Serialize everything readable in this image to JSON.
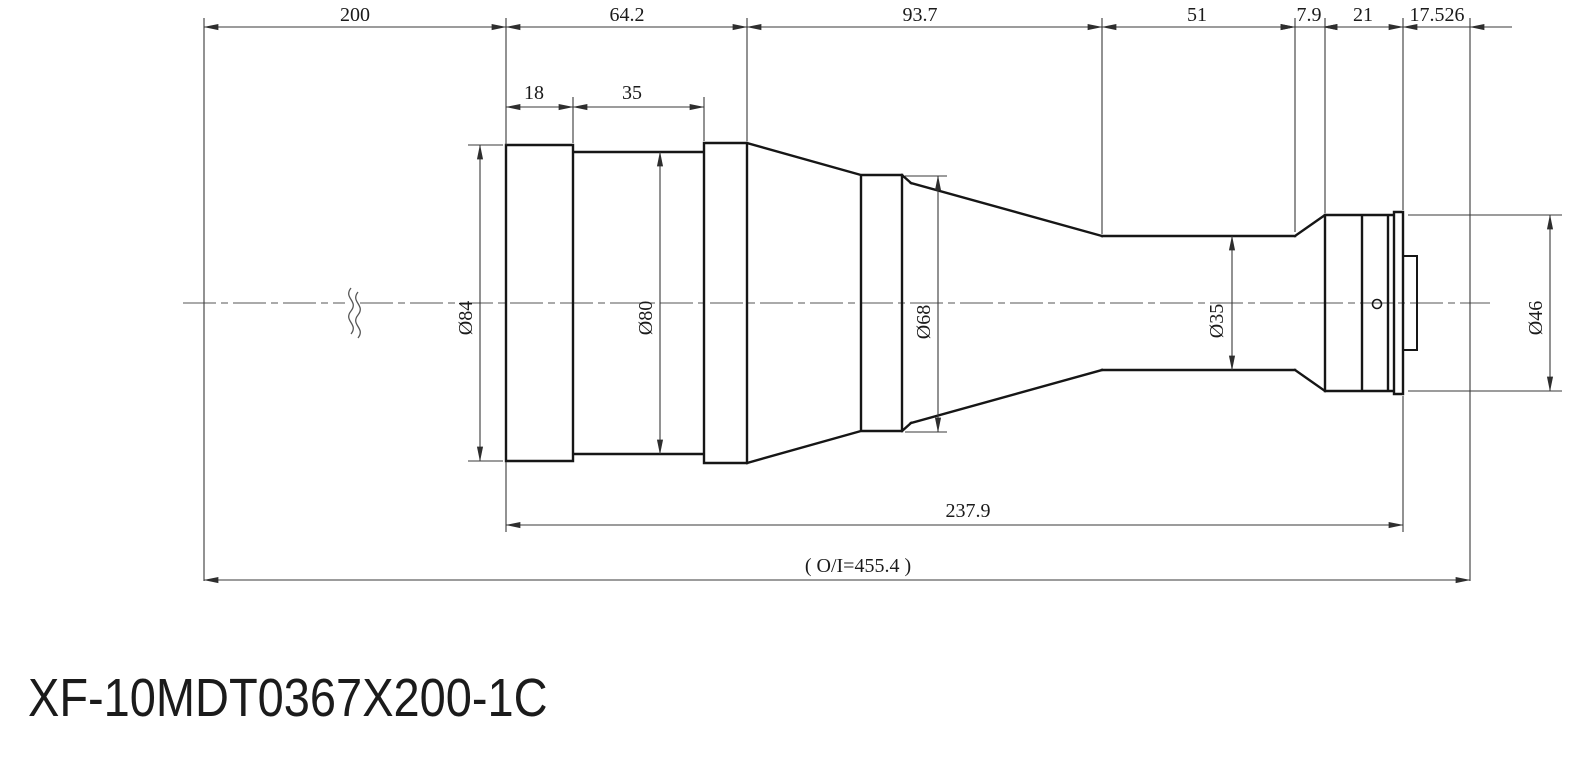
{
  "title": "XF-10MDT0367X200-1C",
  "dims": {
    "top": {
      "d200": "200",
      "d64_2": "64.2",
      "d93_7": "93.7",
      "d51": "51",
      "d7_9": "7.9",
      "d21": "21",
      "d17_526": "17.526"
    },
    "sub": {
      "d18": "18",
      "d35": "35"
    },
    "diameters": {
      "dia84": "Ø84",
      "dia80": "Ø80",
      "dia68": "Ø68",
      "dia35": "Ø35",
      "dia46": "Ø46"
    },
    "bottom": {
      "d237_9": "237.9",
      "oi": "( O/I=455.4 )"
    }
  },
  "colors": {
    "background": "#ffffff",
    "outline": "#161616",
    "dim_line": "#3a3a3a",
    "centerline": "#555555",
    "text": "#1b1b1b"
  }
}
